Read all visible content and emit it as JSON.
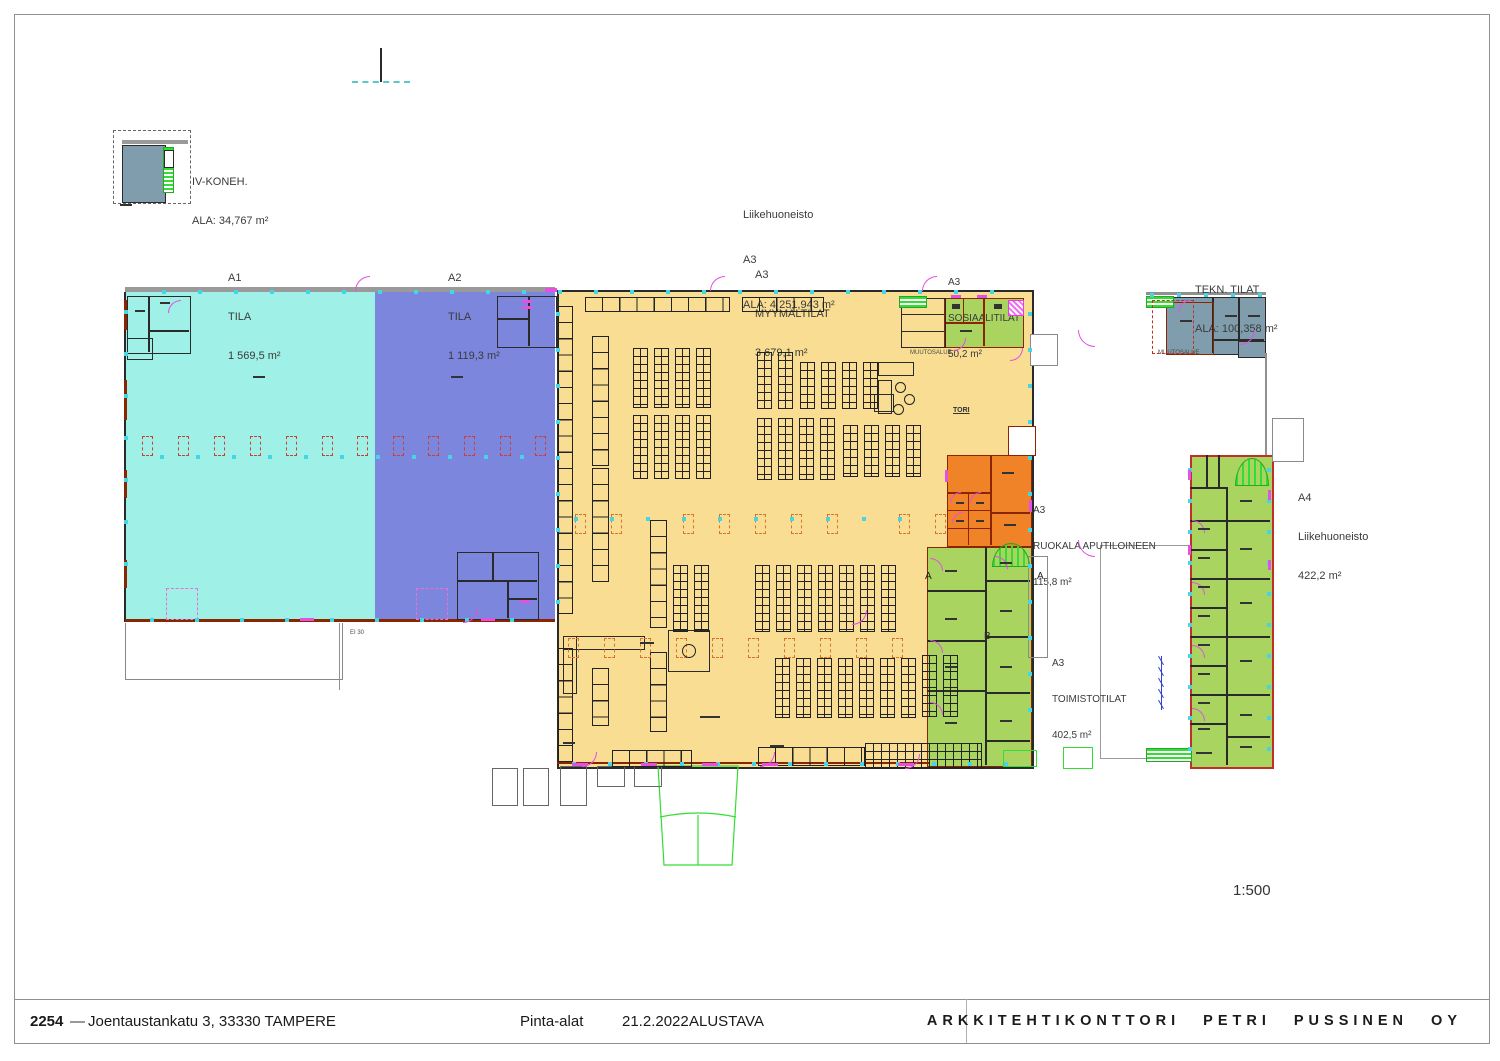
{
  "colors": {
    "a1_cyan": "#9ff0e6",
    "a2_blue": "#7b86dc",
    "a3_yellow": "#f8dd92",
    "green_room": "#a8d45f",
    "orange_room": "#f08228",
    "slate_room": "#7f9dad",
    "bright_green": "#33dd33",
    "magenta": "#e44fe4",
    "wall_red": "#8b2500",
    "column_red": "#cc4034",
    "tick_cyan": "#45d5e5"
  },
  "plan": {
    "labels": {
      "iv_koneh": {
        "line1": "IV-KONEH.",
        "line2": "ALA: 34,767 m²"
      },
      "a1": {
        "line1": "A1",
        "line2": "TILA",
        "line3": "1 569,5 m²"
      },
      "a2": {
        "line1": "A2",
        "line2": "TILA",
        "line3": "1 119,3 m²"
      },
      "liikehuoneisto_a3": {
        "line1": "Liikehuoneisto",
        "line2": "A3",
        "line3": "ALA: 4 251,943 m²"
      },
      "myymalatilat": {
        "line1": "A3",
        "line2": "MYYMÄLTILAT",
        "line3": "3 679,1 m²"
      },
      "sosiaalitilat": {
        "line1": "A3",
        "line2": "SOSIAALITILAT",
        "line3": "50,2 m²"
      },
      "tekn_tilat": {
        "line1": "TEKN. TILAT",
        "line2": "ALA: 100,358 m²"
      },
      "ruokala": {
        "line1": "A3",
        "line2": "RUOKALA APUTILOINEEN",
        "line3": "115,8 m²"
      },
      "a4": {
        "line1": "A4",
        "line2": "Liikehuoneisto",
        "line3": "422,2 m²"
      },
      "toimistotilat": {
        "line1": "A3",
        "line2": "TOIMISTOTILAT",
        "line3": "402,5 m²"
      },
      "muutosalue_left": "MUUTOSALUE",
      "muutosalue_right": "MUUTOSALUE",
      "tori": "TORI",
      "ei30": "EI 30",
      "section_a_left": "A",
      "section_a_right": "A",
      "section_b": "B",
      "scale": "1:500"
    }
  },
  "titleblock": {
    "project_number": "2254",
    "dash": "—",
    "address": "Joentaustankatu 3, 33330 TAMPERE",
    "drawing_type": "Pinta-alat",
    "date": "21.2.2022",
    "status": "ALUSTAVA",
    "firm": "ARKKITEHTIKONTTORI PETRI PUSSINEN OY"
  }
}
